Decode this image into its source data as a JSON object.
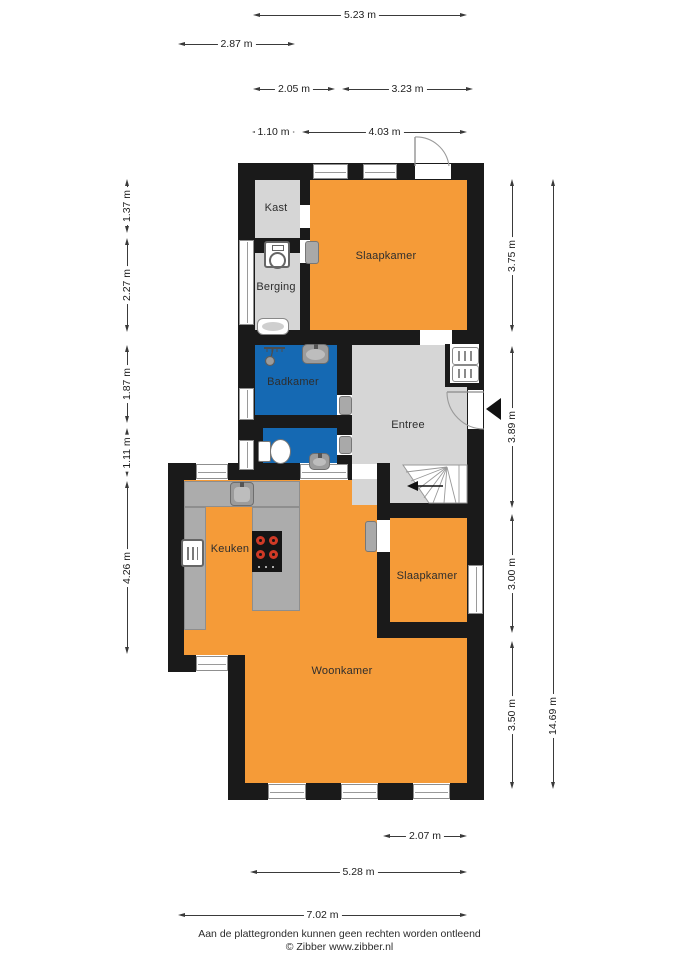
{
  "plan_title": "Begane grond plattegrond",
  "rooms": [
    {
      "id": "kast",
      "label": "Kast",
      "x": 276,
      "y": 208
    },
    {
      "id": "berging",
      "label": "Berging",
      "x": 276,
      "y": 287
    },
    {
      "id": "slaapkamer-1",
      "label": "Slaapkamer",
      "x": 386,
      "y": 256
    },
    {
      "id": "badkamer",
      "label": "Badkamer",
      "x": 293,
      "y": 382
    },
    {
      "id": "entree",
      "label": "Entree",
      "x": 408,
      "y": 425
    },
    {
      "id": "keuken",
      "label": "Keuken",
      "x": 230,
      "y": 549
    },
    {
      "id": "slaapkamer-2",
      "label": "Slaapkamer",
      "x": 427,
      "y": 576
    },
    {
      "id": "woonkamer",
      "label": "Woonkamer",
      "x": 342,
      "y": 671
    }
  ],
  "dimensions": {
    "horizontal": [
      {
        "label": "5.23 m",
        "x1": 253,
        "x2": 467,
        "y": 15
      },
      {
        "label": "2.87 m",
        "x1": 178,
        "x2": 295,
        "y": 44
      },
      {
        "label": "2.05 m",
        "x1": 253,
        "x2": 335,
        "y": 89
      },
      {
        "label": "3.23 m",
        "x1": 342,
        "x2": 473,
        "y": 89
      },
      {
        "label": "1.10 m",
        "x1": 252,
        "x2": 295,
        "y": 132
      },
      {
        "label": "4.03 m",
        "x1": 302,
        "x2": 467,
        "y": 132
      },
      {
        "label": "2.07 m",
        "x1": 383,
        "x2": 467,
        "y": 836
      },
      {
        "label": "5.28 m",
        "x1": 250,
        "x2": 467,
        "y": 872
      },
      {
        "label": "7.02 m",
        "x1": 178,
        "x2": 467,
        "y": 915
      }
    ],
    "vertical": [
      {
        "label": "1.37 m",
        "y1": 179,
        "y2": 233,
        "x": 127
      },
      {
        "label": "2.27 m",
        "y1": 238,
        "y2": 332,
        "x": 127
      },
      {
        "label": "1.87 m",
        "y1": 345,
        "y2": 423,
        "x": 127
      },
      {
        "label": "1.11 m",
        "y1": 428,
        "y2": 477,
        "x": 127
      },
      {
        "label": "4.26 m",
        "y1": 481,
        "y2": 654,
        "x": 127
      },
      {
        "label": "3.75 m",
        "y1": 179,
        "y2": 332,
        "x": 512
      },
      {
        "label": "3.89 m",
        "y1": 346,
        "y2": 508,
        "x": 512
      },
      {
        "label": "3.00 m",
        "y1": 514,
        "y2": 633,
        "x": 512
      },
      {
        "label": "3.50 m",
        "y1": 641,
        "y2": 789,
        "x": 512
      },
      {
        "label": "14.69 m",
        "y1": 179,
        "y2": 789,
        "x": 553,
        "lp": 0.88
      }
    ]
  },
  "footer": {
    "disclaimer": "Aan de plattegronden kunnen geen rechten worden ontleend",
    "credit": "© Zibber www.zibber.nl"
  },
  "colors": {
    "wall": "#1a1a1a",
    "room_orange": "#f59b38",
    "room_blue": "#1569b3",
    "room_gray": "#d6d6d6",
    "counter_gray": "#acacac",
    "fixture_gray": "#9c9c9c",
    "burner_red": "#cf3a26",
    "dim_line": "#3a3a3a"
  },
  "icons": [
    "washing-machine-icon",
    "doormat-icon",
    "shower-icon",
    "sink-icon",
    "toilet-icon",
    "meter-cupboard-icon",
    "kitchen-sink-icon",
    "oven-icon",
    "cooktop-icon",
    "stairs-icon",
    "door-arc-icon",
    "entrance-arrow-icon"
  ]
}
